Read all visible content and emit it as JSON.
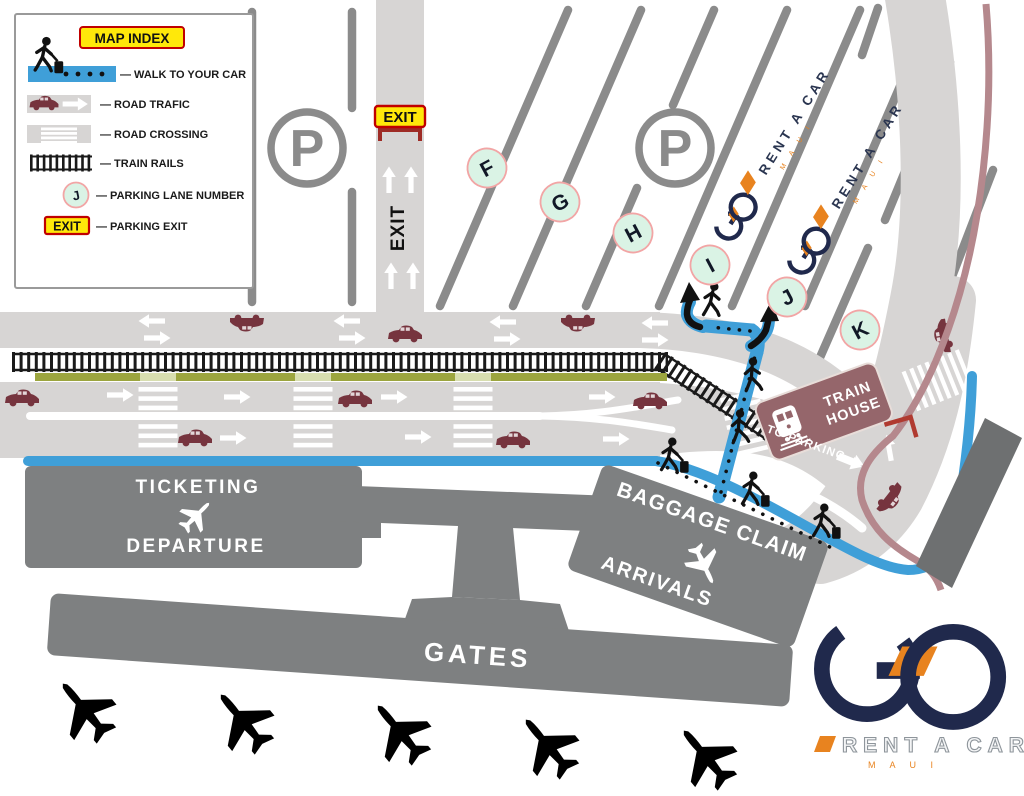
{
  "legend": {
    "title": "MAP INDEX",
    "items": [
      {
        "icon": "walk-path-icon",
        "label": "— WALK TO YOUR CAR"
      },
      {
        "icon": "road-traffic-icon",
        "label": "— ROAD TRAFIC"
      },
      {
        "icon": "road-crossing-icon",
        "label": "— ROAD CROSSING"
      },
      {
        "icon": "train-rails-icon",
        "label": "— TRAIN RAILS"
      },
      {
        "icon": "parking-lane-number-icon",
        "label": "— PARKING LANE NUMBER",
        "badge": "J"
      },
      {
        "icon": "parking-exit-icon",
        "label": "—  PARKING EXIT",
        "badge": "EXIT"
      }
    ]
  },
  "map": {
    "parking_symbol": "P",
    "lane_letters": [
      "F",
      "G",
      "H",
      "I",
      "J",
      "K"
    ],
    "exit_sign": "EXIT",
    "exit_road_label": "EXIT",
    "train_house_line1": "TRAIN",
    "train_house_line2": "HOUSE",
    "to_parking": "TO PARKING",
    "ticketing": "TICKETING",
    "departure": "DEPARTURE",
    "baggage_claim": "BAGGAGE CLAIM",
    "arrivals": "ARRIVALS",
    "gates": "GATES"
  },
  "brand": {
    "name": "RENT A CAR",
    "sub": "M A U I"
  },
  "colors": {
    "walk_blue": "#3F9FD8",
    "navy": "#20294C",
    "orange": "#E8831F",
    "road_gray": "#D7D5D4",
    "divider_gray": "#8B8B8B",
    "building_gray": "#7E8081",
    "car_maroon": "#76343E",
    "train_mauve": "#95666B",
    "rail_rose": "#B5888D",
    "olive": "#9CA53F",
    "mint": "#DAF3E5",
    "mint_border": "#F2A5A5",
    "sign_yellow": "#FFE80A",
    "sign_red": "#C00000"
  }
}
